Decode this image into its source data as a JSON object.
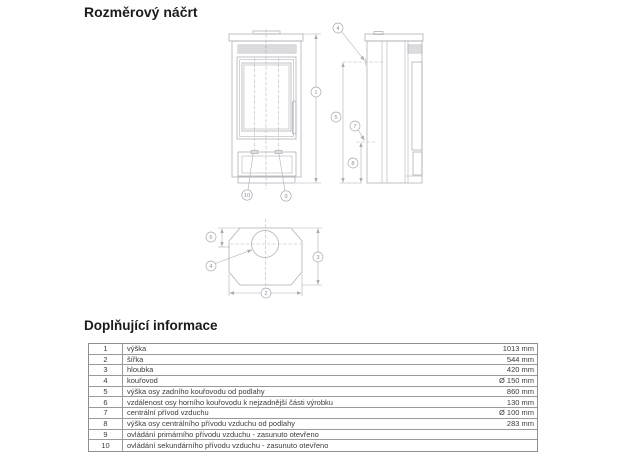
{
  "page": {
    "title": "Rozměrový náčrt"
  },
  "drawing": {
    "line_color": "#abadb4",
    "views": [
      "front-view",
      "side-view",
      "top-view"
    ],
    "callout_numbers": {
      "n1": "1",
      "n2": "2",
      "n3": "3",
      "n4": "4",
      "n5": "5",
      "n6": "6",
      "n7": "7",
      "n8": "8",
      "n9": "9",
      "n10": "10"
    }
  },
  "info": {
    "title": "Doplňující informace",
    "rows": [
      {
        "num": "1",
        "label": "výška",
        "value": "1013 mm"
      },
      {
        "num": "2",
        "label": "šířka",
        "value": "544 mm"
      },
      {
        "num": "3",
        "label": "hloubka",
        "value": "420 mm"
      },
      {
        "num": "4",
        "label": "kouřovod",
        "value": "Ø 150 mm"
      },
      {
        "num": "5",
        "label": "výška osy zadního kouřovodu od podlahy",
        "value": "860 mm"
      },
      {
        "num": "6",
        "label": "vzdálenost osy horního kouřovodu k nejzadnější části výrobku",
        "value": "130 mm"
      },
      {
        "num": "7",
        "label": "centrální přívod vzduchu",
        "value": "Ø 100 mm"
      },
      {
        "num": "8",
        "label": "výška osy centrálního přívodu vzduchu od podlahy",
        "value": "283 mm"
      },
      {
        "num": "9",
        "label": "ovládání primárního přívodu vzduchu - zasunuto otevřeno",
        "value": ""
      },
      {
        "num": "10",
        "label": "ovládání sekundárního přívodu vzduchu - zasunuto otevřeno",
        "value": ""
      }
    ]
  }
}
